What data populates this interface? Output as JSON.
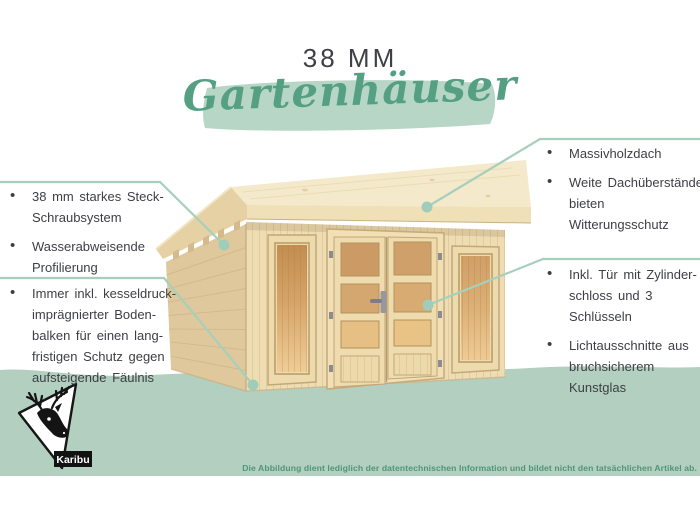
{
  "header": {
    "size_label": "38 MM",
    "category_script": "Gartenhäuser"
  },
  "callouts": {
    "left_top": {
      "items": [
        "38 mm starkes Steck-\nSchraubsystem",
        "Wasserabweisende\nProfilierung"
      ]
    },
    "left_bottom": {
      "items": [
        "Immer inkl. kesseldruck-\nimprägnierter Boden-\nbalken für einen lang-\nfristigen Schutz gegen\naufsteigende Fäulnis"
      ]
    },
    "right_top": {
      "items": [
        "Massivholzdach",
        "Weite Dachüberstände\nbieten Witterungsschutz"
      ]
    },
    "right_bottom": {
      "items": [
        "Inkl. Tür mit Zylinder-\nschloss und 3 Schlüsseln",
        "Lichtausschnitte aus\nbruchsicherem Kunstglas"
      ]
    }
  },
  "footer": {
    "disclaimer": "Die Abbildung dient lediglich der datentechnischen Information und bildet nicht den tatsächlichen Artikel ab.",
    "brand": "Karibu"
  },
  "icons": {
    "logo": "deer-icon"
  },
  "colors": {
    "accent_green": "#55a083",
    "brush_green": "#b8d6c6",
    "band_green": "#b2cfc0",
    "callout_line": "#a6cfbc",
    "text_dark": "#3e3f44",
    "disclaimer_green": "#4e9579",
    "wood_front": "#eedcb3",
    "wood_side": "#e0c89d",
    "wood_roof": "#f5e9cb",
    "glass_amber": "#d2a065"
  }
}
